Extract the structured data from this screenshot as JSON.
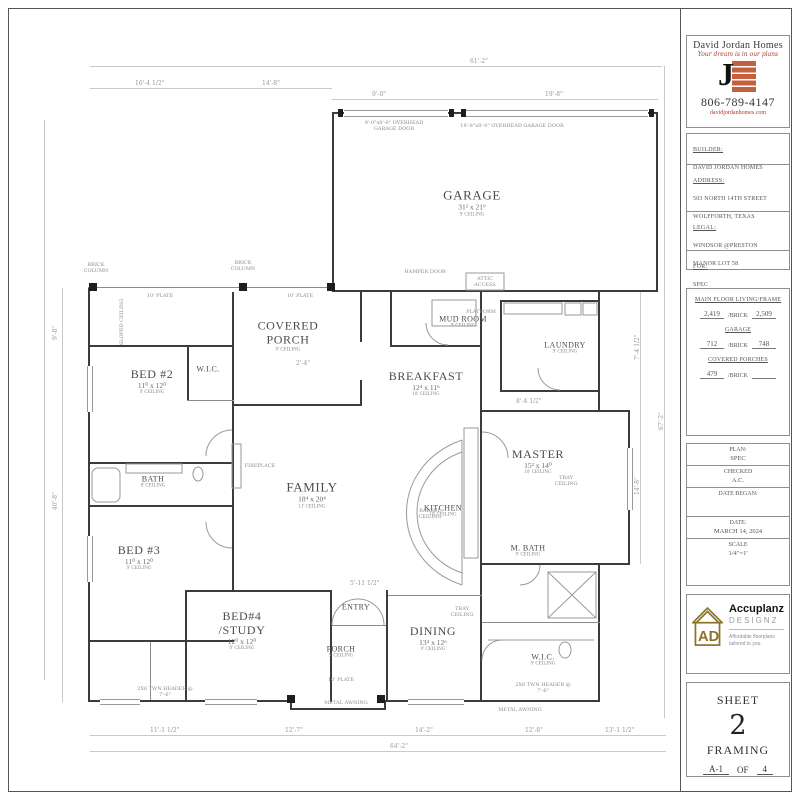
{
  "logo": {
    "company": "David Jordan Homes",
    "tagline": "Your dream is in our plans",
    "monogram": "J",
    "phone": "806-789-4147",
    "website": "davidjordanhomes.com"
  },
  "info": {
    "builder_label": "BUILDER:",
    "builder": "DAVID JORDAN HOMES",
    "address_label": "ADDRESS:",
    "address1": "503 NORTH 14TH STREET",
    "address2": "WOLFFORTH, TEXAS",
    "legal_label": "LEGAL:",
    "legal1": "WINDSOR @PRESTON",
    "legal2": "MANOR LOT 58",
    "for_label": "FOR:",
    "for": "SPEC"
  },
  "areas": {
    "living_label": "MAIN FLOOR LIVING/FRAME",
    "living": "2,419",
    "brick_label": "/BRICK",
    "living_brick": "2,509",
    "garage_label": "GARAGE",
    "garage": "712",
    "garage_brick": "748",
    "porches_label": "COVERED PORCHES",
    "porches": "479",
    "porches_brick": ""
  },
  "block": {
    "plan_label": "PLAN:",
    "plan": "SPEC",
    "checked_label": "CHECKED",
    "checked": "A.C.",
    "date_began_label": "DATE BEGAN:",
    "date_label": "DATE:",
    "date": "MARCH 14, 2024",
    "scale_label": "SCALE",
    "scale": "1/4\"=1'"
  },
  "designer": {
    "name": "Accuplanz",
    "sub": "DESIGNZ",
    "tag1": "Affordable floorplans",
    "tag2": "tailored to you.",
    "monogram": "AD"
  },
  "sheet": {
    "label": "SHEET",
    "number": "2",
    "type": "FRAMING",
    "code": "A-1",
    "of": "OF",
    "total": "4"
  },
  "plan": {
    "rooms": [
      {
        "name": "GARAGE",
        "dims": "31² x 21⁹",
        "ceiling": "9' CEILING"
      },
      {
        "name": "COVERED PORCH",
        "ceiling": "9' CEILING"
      },
      {
        "name": "BED #2",
        "dims": "11⁰ x 12⁰",
        "ceiling": "9' CEILING"
      },
      {
        "name": "W.I.C."
      },
      {
        "name": "BATH",
        "ceiling": "8' CEILING"
      },
      {
        "name": "BED #3",
        "dims": "11⁰ x 12⁰",
        "ceiling": "9' CEILING"
      },
      {
        "name": "MUD ROOM",
        "ceiling": "9' CEILING"
      },
      {
        "name": "LAUNDRY",
        "ceiling": "9' CEILING"
      },
      {
        "name": "BREAKFAST",
        "dims": "12⁴ x 11⁶",
        "ceiling": "10' CEILING"
      },
      {
        "name": "FAMILY",
        "dims": "18⁴ x 20⁴",
        "ceiling": "11' CEILING"
      },
      {
        "name": "KITCHEN",
        "ceiling": "10' CEILING"
      },
      {
        "name": "MASTER",
        "dims": "15² x 14⁰",
        "ceiling": "10' CEILING"
      },
      {
        "name": "M. BATH",
        "ceiling": "9' CEILING"
      },
      {
        "name": "ENTRY"
      },
      {
        "name": "BED#4 /STUDY",
        "dims": "12⁰ x 12⁰",
        "ceiling": "9' CEILING"
      },
      {
        "name": "PORCH",
        "ceiling": "9' CEILING"
      },
      {
        "name": "DINING",
        "dims": "13⁴ x 12⁶",
        "ceiling": "9' CEILING"
      },
      {
        "name": "W.I.C.",
        "ceiling": "9' CEILING"
      }
    ],
    "notes": [
      "9'-0\"x8'-0\" OVERHEAD GARAGE DOOR",
      "18'-8\"x8'-0\" OVERHEAD GARAGE DOOR",
      "HAMPER DOOR",
      "ATTIC ACCESS",
      "BRICK COLUMN",
      "10' PLATE",
      "TRAY CEILING",
      "BARREL CEILING",
      "METAL AWNING",
      "2X6 TWN HEADER @ 7'-6\"",
      "PLATFORM",
      "FIREPLACE",
      "SLOPED CEILING"
    ],
    "dims": [
      "16'-4 1/2\"",
      "14'-8\"",
      "61'-2\"",
      "9'-0\"",
      "19'-8\"",
      "11'-1 1/2\"",
      "12'-7\"",
      "14'-2\"",
      "12'-8\"",
      "13'-1 1/2\"",
      "64'-2\"",
      "9'-8\"",
      "40'-8\"",
      "67'-2\"",
      "7'-4 1/2\"",
      "14'-8\"",
      "2'-4\"",
      "8'-4 1/2\"",
      "5'-11 1/2\""
    ]
  }
}
